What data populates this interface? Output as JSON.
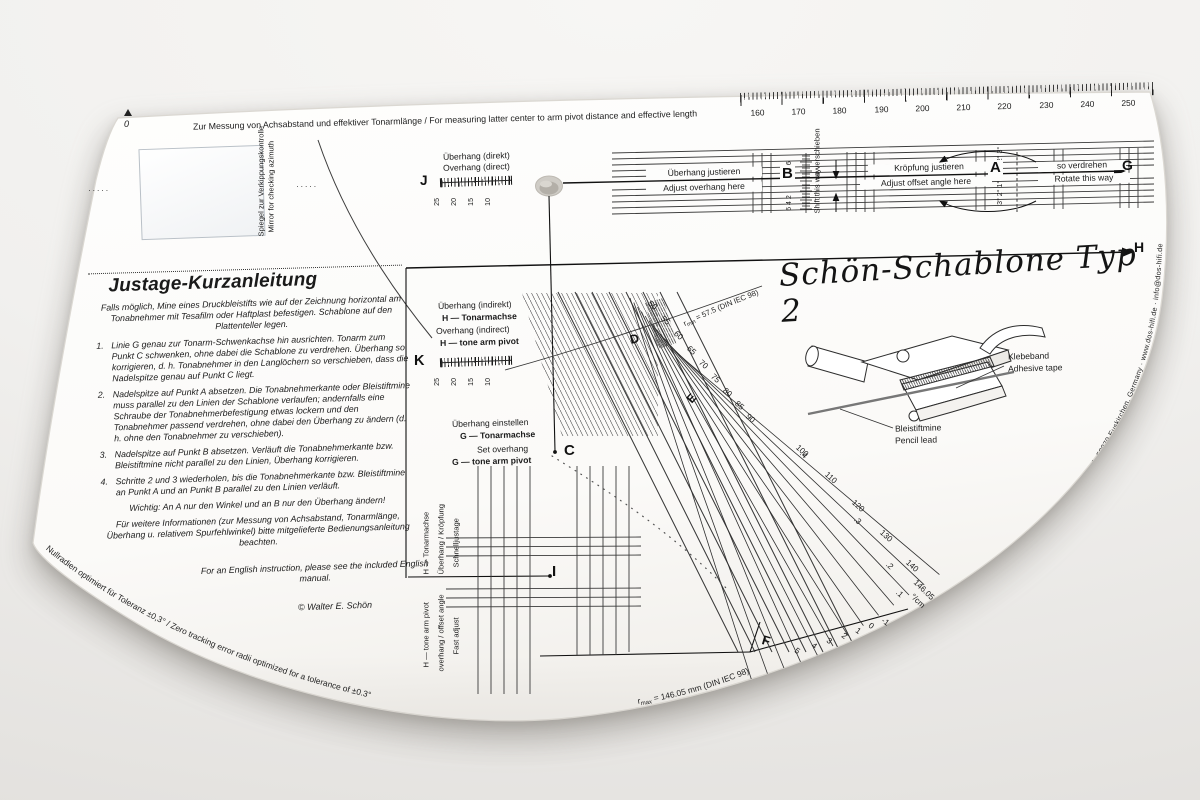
{
  "title": "Schön-Schablone Typ 2",
  "top": {
    "note": "Zur Messung von Achsabstand und effektiver Tonarmlänge / For measuring latter center to arm pivot distance and effective length",
    "zero": "0",
    "ruler_values": [
      "160",
      "170",
      "180",
      "190",
      "200",
      "210",
      "220",
      "230",
      "240",
      "250"
    ]
  },
  "mirror": {
    "de": "Spiegel zur Verkippungskontrolle",
    "en": "Mirror for checking azimuth",
    "dots": "·····"
  },
  "band": {
    "overhang_de": "Überhang justieren",
    "overhang_en": "Adjust overhang here",
    "offset_de": "Kröpfung justieren",
    "offset_en": "Adjust offset angle here",
    "rotate_de": "so verdrehen",
    "rotate_en": "Rotate this way",
    "shift_de": "so verschieben",
    "shift_en": "Shift this way",
    "mini_top": "2 4 6",
    "mini_bottom": "6 4 2",
    "deg_top": "1° 2° 3°",
    "deg_bottom": "3° 2° 1°"
  },
  "points": {
    "a": "A",
    "b": "B",
    "c": "C",
    "d": "D",
    "e": "E",
    "f": "F",
    "g": "G",
    "h": "H",
    "i": "I",
    "j": "J",
    "k": "K"
  },
  "j_scale": {
    "de": "Überhang (direkt)",
    "en": "Overhang (direct)",
    "values": [
      "25",
      "20",
      "15",
      "10"
    ]
  },
  "k_scale": {
    "de1": "Überhang (indirekt)",
    "de2": "H — Tonarmachse",
    "en1": "Overhang (indirect)",
    "en2": "H — tone arm pivot",
    "values": [
      "25",
      "20",
      "15",
      "10"
    ]
  },
  "g_set": {
    "de1": "Überhang einstellen",
    "de2": "G — Tonarmachse",
    "en1": "Set overhang",
    "en2": "G — tone arm pivot"
  },
  "fast": {
    "de1": "Schnelljustage",
    "de2": "Überhang / Kröpfung",
    "de3": "H — Tonarmachse",
    "en1": "Fast adjust",
    "en2": "overhang / offset angle",
    "en3": "H — tone arm pivot"
  },
  "instructions": {
    "heading": "Justage-Kurzanleitung",
    "intro": "Falls möglich, Mine eines Druckbleistifts wie auf der Zeichnung horizontal am Tonabnehmer mit Tesafilm oder Haftplast befestigen. Schablone auf den Plattenteller legen.",
    "steps": [
      {
        "num": "1.",
        "text": "Linie G genau zur Tonarm-Schwenkachse hin ausrichten. Tonarm zum Punkt C schwenken, ohne dabei die Schablone zu verdrehen. Überhang so korrigieren, d. h. Tonabnehmer in den Langlöchern so verschieben, dass die Nadelspitze genau auf Punkt C liegt."
      },
      {
        "num": "2.",
        "text": "Nadelspitze auf Punkt A absetzen. Die Tonabnehmerkante oder Bleistiftmine muss parallel zu den Linien der Schablone verlaufen; andernfalls eine Schraube der Tonabnehmerbefestigung etwas lockern und den Tonabnehmer passend verdrehen, ohne dabei den Überhang zu ändern (d. h. ohne den Tonabnehmer zu verschieben)."
      },
      {
        "num": "3.",
        "text": "Nadelspitze auf Punkt B absetzen. Verläuft die Tonabnehmerkante bzw. Bleistiftmine nicht parallel zu den Linien, Überhang korrigieren."
      },
      {
        "num": "4.",
        "text": "Schritte 2 und 3 wiederholen, bis die Tonabnehmerkante bzw. Bleistiftmine an Punkt A und an Punkt B parallel zu den Linien verläuft."
      }
    ],
    "important": "Wichtig: An A nur den Winkel und an B nur den Überhang ändern!",
    "more": "Für weitere Informationen (zur Messung von Achsabstand, Tonarmlänge, Überhang u. relativem Spurfehlwinkel) bitte mitgelieferte Bedienungsanleitung beachten.",
    "english": "For an English instruction, please see the included English manual.",
    "copyright": "© Walter E. Schön"
  },
  "fan": {
    "radius_values": [
      "50",
      "55",
      "60",
      "65",
      "70",
      "75",
      "80",
      "85",
      "90",
      "100",
      "110",
      "120",
      "130",
      "140"
    ],
    "decimals": [
      ".4",
      ".3",
      ".2",
      ".1"
    ],
    "deg_values": [
      "5",
      "4",
      "3",
      "2",
      "1",
      "0",
      "-1"
    ],
    "value_146": "146.05",
    "deg_unit": "°/cm",
    "r_min_pre": "r",
    "r_min_sub": "min",
    "r_min_rest": " = 57.5 (DIN IEC 98)",
    "r_max_pre": "r",
    "r_max_sub": "max",
    "r_max_rest": " = 146.05 mm (DIN IEC 98)"
  },
  "cartridge": {
    "tape_de": "Klebeband",
    "tape_en": "Adhesive tape",
    "lead_de": "Bleistiftmine",
    "lead_en": "Pencil lead"
  },
  "edge": {
    "bottom_left": "Nullradien optimiert für Toleranz ±0,3° / Zero tracking error radii optimized for a tolerance of ±0.3°",
    "right": "Vertrieb: DOS GmbH, Rudolf-Diesel-Str. 1, 53879 Euskirchen, Germany · www.dos-hifi.de · info@dos-hifi.de"
  }
}
